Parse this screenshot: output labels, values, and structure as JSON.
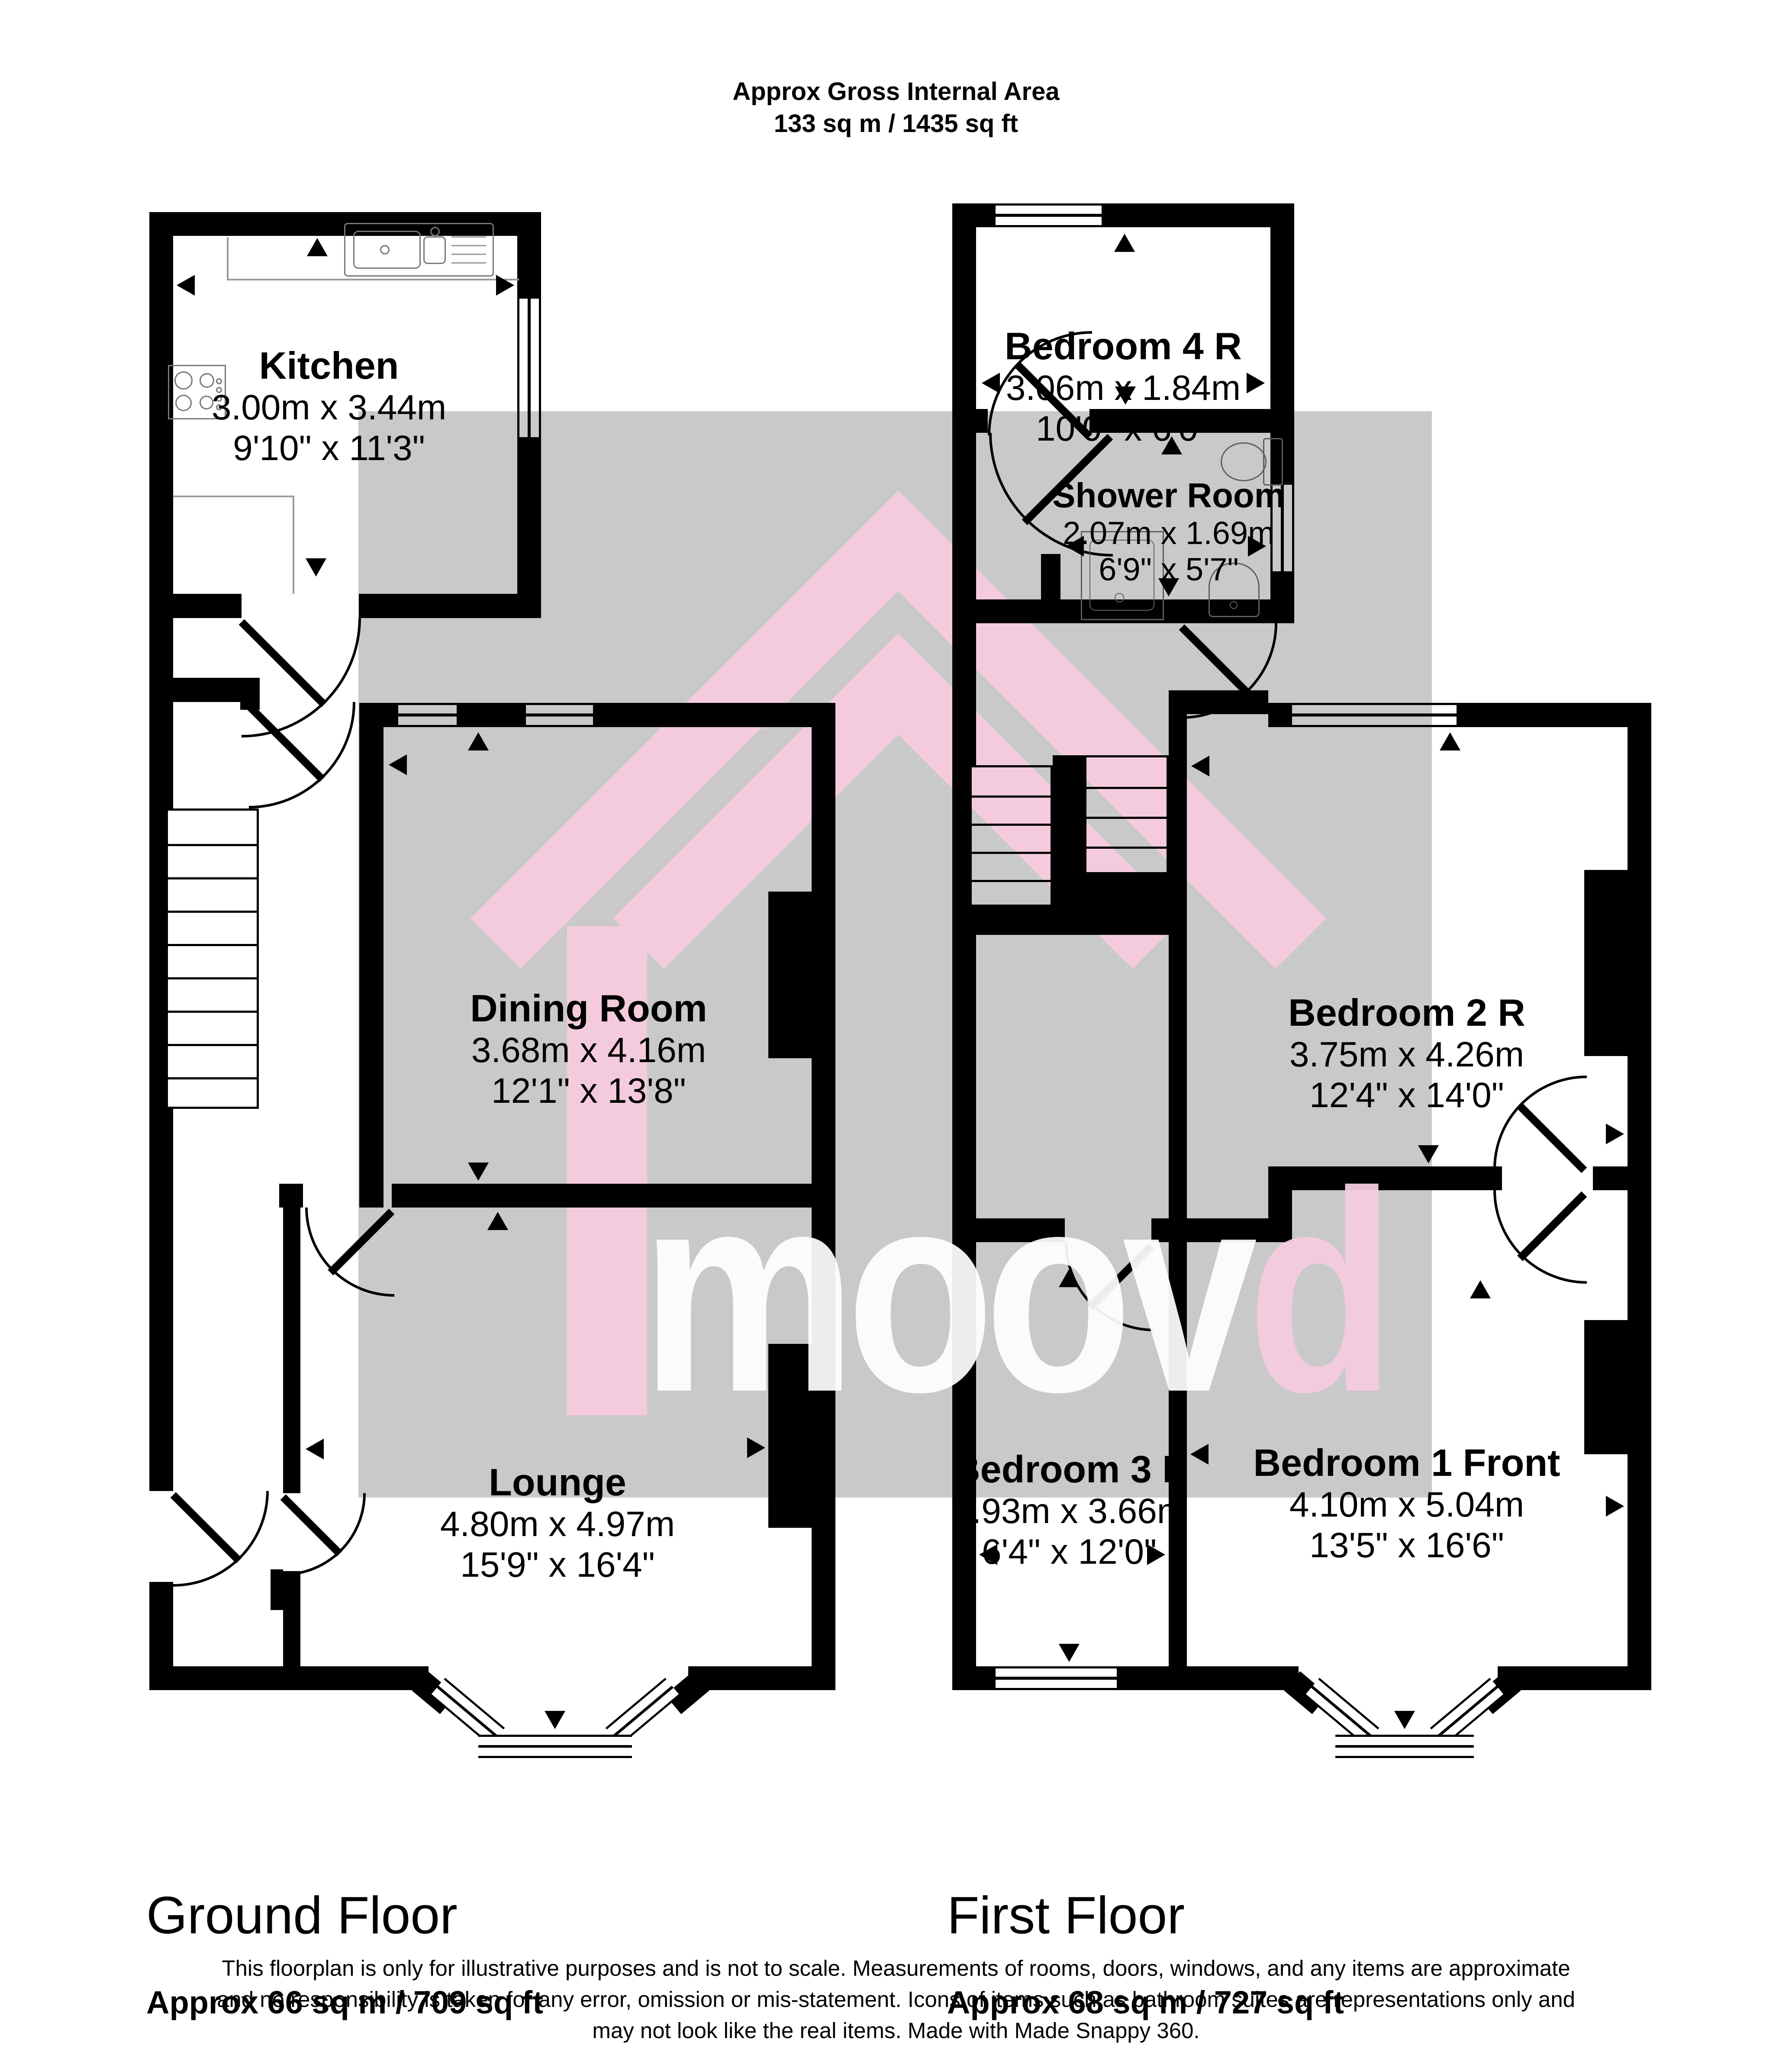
{
  "header": {
    "title": "Approx Gross Internal Area",
    "area": "133 sq m / 1435 sq ft"
  },
  "floors": [
    {
      "label": "Ground Floor",
      "area_label": "Approx 66 sq m / 709 sq ft",
      "rooms": [
        {
          "name": "Kitchen",
          "metric": "3.00m x 3.44m",
          "imperial": "9'10\" x 11'3\""
        },
        {
          "name": "Dining Room",
          "metric": "3.68m x 4.16m",
          "imperial": "12'1\" x 13'8\""
        },
        {
          "name": "Lounge",
          "metric": "4.80m x 4.97m",
          "imperial": "15'9\" x 16'4\""
        }
      ]
    },
    {
      "label": "First Floor",
      "area_label": "Approx 68 sq m / 727 sq ft",
      "rooms": [
        {
          "name": "Bedroom 4 R",
          "metric": "3.06m x 1.84m",
          "imperial": "10'0\" x 6'0\""
        },
        {
          "name": "Shower Room",
          "metric": "2.07m x 1.69m",
          "imperial": "6'9\" x 5'7\""
        },
        {
          "name": "Bedroom 2 R",
          "metric": "3.75m x 4.26m",
          "imperial": "12'4\" x 14'0\""
        },
        {
          "name": "Bedroom 3 F",
          "metric": "1.93m x 3.66m",
          "imperial": "6'4\" x 12'0\""
        },
        {
          "name": "Bedroom 1 Front",
          "metric": "4.10m x 5.04m",
          "imperial": "13'5\" x 16'6\""
        }
      ]
    }
  ],
  "watermark": {
    "word_main": "moov",
    "word_accent": "d",
    "shape_color": "#f4cbdd",
    "grey_color": "#c9c9c9",
    "accent_color": "#f5cbdf"
  },
  "footer": {
    "line1": "This floorplan is only for illustrative purposes and is not to scale. Measurements of rooms, doors, windows, and any items are approximate",
    "line2": "and no responsibility is taken for any error, omission or mis-statement. Icons of items such as bathroom suites are representations only and",
    "line3": "may not look like the real items. Made with Made Snappy 360."
  },
  "icons": {
    "sink": "sink-icon",
    "hob": "hob-icon",
    "toilet": "toilet-icon",
    "shower": "shower-tray-icon",
    "basin": "basin-icon"
  }
}
